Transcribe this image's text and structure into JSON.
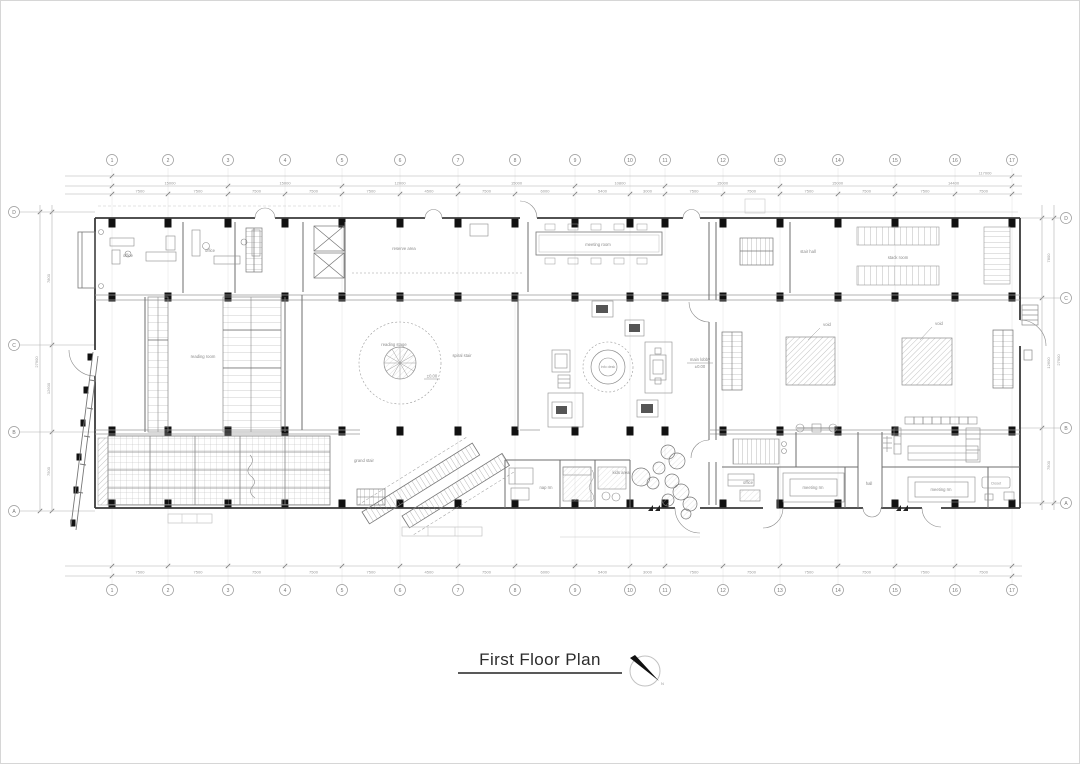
{
  "drawing": {
    "title": "First Floor Plan",
    "north_label": "N"
  },
  "grid": {
    "cols": [
      "1",
      "2",
      "3",
      "4",
      "5",
      "6",
      "7",
      "8",
      "9",
      "10",
      "11",
      "12",
      "13",
      "14",
      "15",
      "16",
      "17"
    ],
    "rows": [
      "D",
      "C",
      "B",
      "A"
    ]
  },
  "dims": {
    "top_major": [
      "15000",
      "15000",
      "12000",
      "15000",
      "10800",
      "15000",
      "15000",
      "14400"
    ],
    "top_minor": [
      "7500",
      "7500",
      "7500",
      "7500",
      "7500",
      "4500",
      "7500",
      "6000",
      "5400",
      "3000",
      "7500",
      "7500",
      "7500",
      "7500",
      "7500",
      "7500"
    ],
    "bottom": [
      "7500",
      "7500",
      "7500",
      "7500",
      "7500",
      "4500",
      "7500",
      "6000",
      "5400",
      "3000",
      "7500",
      "7500",
      "7500",
      "7500",
      "7500",
      "7500"
    ],
    "overall_top": "117000",
    "left": [
      "7800",
      "12600",
      "7500"
    ],
    "right": [
      "7800",
      "12600",
      "7500"
    ],
    "overall_left": "27900",
    "overall_right": "27900"
  },
  "labels": {
    "office_a": "office",
    "office_b": "office",
    "reserve": "reserve area",
    "meeting": "meeting room",
    "stair_hall": "stair hall",
    "stacks": "stack room",
    "reading_room": "reading room",
    "reading_stage": "reading stage",
    "spiral_note": "spiral stair",
    "level_note": "±0.00",
    "info_desk": "info desk",
    "lobby_note": "main lobby",
    "lobby_level": "±0.00",
    "void_a": "void",
    "void_b": "void",
    "ramp_note": "grand stair",
    "nap": "nap rm",
    "kids": "kids area",
    "office_c": "office",
    "meeting_b": "meeting rm",
    "hall_note": "hall",
    "meeting_c": "meeting rm",
    "closet": "Closet"
  }
}
